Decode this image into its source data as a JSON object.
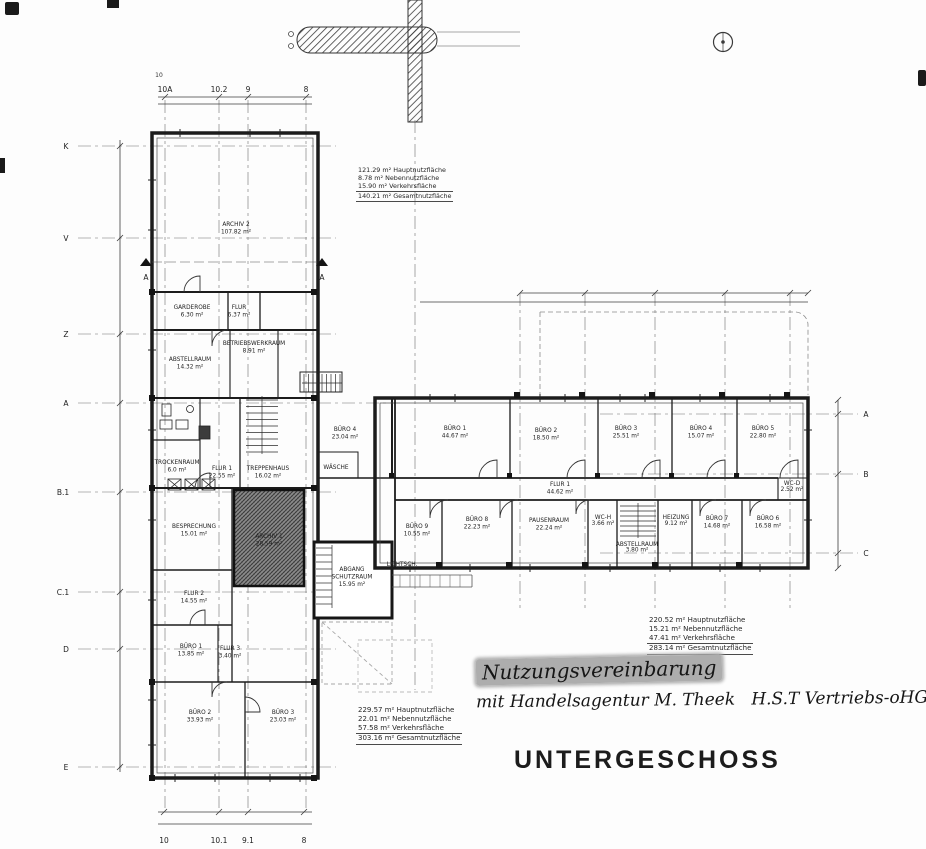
{
  "page": {
    "title": "UNTERGESCHOSS"
  },
  "handwriting": {
    "line1": "Nutzungsvereinbarung",
    "line2": "mit Handelsagentur M. Theek   H.S.T Vertriebs-oHG"
  },
  "area_summaries": {
    "wing_top": [
      "121.29 m² Hauptnutzfläche",
      "8.78 m² Nebennutzfläche",
      "15.90 m² Verkehrsfläche",
      "140.21 m² Gesamtnutzfläche"
    ],
    "wing_bottom": [
      "229.57 m² Hauptnutzfläche",
      "22.01 m² Nebennutzfläche",
      "57.58 m² Verkehrsfläche",
      "303.16 m² Gesamtnutzfläche"
    ],
    "wing_right": [
      "220.52 m² Hauptnutzfläche",
      "15.21 m² Nebennutzfläche",
      "47.41 m² Verkehrsfläche",
      "283.14 m² Gesamtnutzfläche"
    ]
  },
  "rooms": [
    {
      "name": "ARCHIV 2",
      "area": "107.82 m²"
    },
    {
      "name": "GARDEROBE",
      "area": "6.30 m²"
    },
    {
      "name": "FLUR",
      "area": "6.37 m²"
    },
    {
      "name": "BETRIEBSWERKRAUM",
      "area": "8.91 m²"
    },
    {
      "name": "ABSTELLRAUM",
      "area": "14.32 m²"
    },
    {
      "name": "TREPPENHAUS",
      "area": "16.02 m²"
    },
    {
      "name": "FLUR 1",
      "area": "22.55 m²"
    },
    {
      "name": "TROCKENRAUM",
      "area": "6.0 m²"
    },
    {
      "name": "BESPRECHUNG",
      "area": "15.01 m²"
    },
    {
      "name": "ARCHIV 1",
      "area": "28.59 m²"
    },
    {
      "name": "FLUR 2",
      "area": "14.55 m²"
    },
    {
      "name": "BÜRO 1",
      "area": "13.85 m²"
    },
    {
      "name": "FLUR 3",
      "area": "3.40 m²"
    },
    {
      "name": "BÜRO 2",
      "area": "33.93 m²"
    },
    {
      "name": "BÜRO 3",
      "area": "23.03 m²"
    },
    {
      "name": "ABGANG",
      "name2": "SCHUTZRAUM",
      "area": "15.95 m²"
    },
    {
      "name": "WÄSCHE",
      "area": ""
    },
    {
      "name": "LICHTSCH.",
      "area": ""
    },
    {
      "name": "BÜRO 4",
      "area": "23.04 m²"
    },
    {
      "name": "BÜRO 1",
      "area": "44.67 m²"
    },
    {
      "name": "BÜRO 2",
      "area": "18.50 m²"
    },
    {
      "name": "BÜRO 3",
      "area": "25.51 m²"
    },
    {
      "name": "BÜRO 4",
      "area": "15.07 m²"
    },
    {
      "name": "BÜRO 5",
      "area": "22.80 m²"
    },
    {
      "name": "FLUR 1",
      "area": "44.62 m²"
    },
    {
      "name": "WC-D",
      "area": "2.52 m²"
    },
    {
      "name": "BÜRO 9",
      "area": "10.55 m²"
    },
    {
      "name": "BÜRO 8",
      "area": "22.23 m²"
    },
    {
      "name": "PAUSENRAUM",
      "area": "22.24 m²"
    },
    {
      "name": "WC-H",
      "area": "3.66 m²"
    },
    {
      "name": "ABSTELLRAUM",
      "area": "3.80 m²"
    },
    {
      "name": "HEIZUNG",
      "area": "9.12 m²"
    },
    {
      "name": "BÜRO 7",
      "area": "14.68 m²"
    },
    {
      "name": "BÜRO 6",
      "area": "16.58 m²"
    }
  ],
  "axes": {
    "top_small": "10",
    "top": [
      "10A",
      "10.2",
      "9",
      "8"
    ],
    "bottom": [
      "10",
      "10.1",
      "9.1",
      "8"
    ],
    "left": [
      "K",
      "V",
      "Z",
      "A",
      "B.1",
      "C.1",
      "D",
      "E"
    ],
    "right": [
      "A",
      "B",
      "C"
    ],
    "section_mark": "A"
  }
}
